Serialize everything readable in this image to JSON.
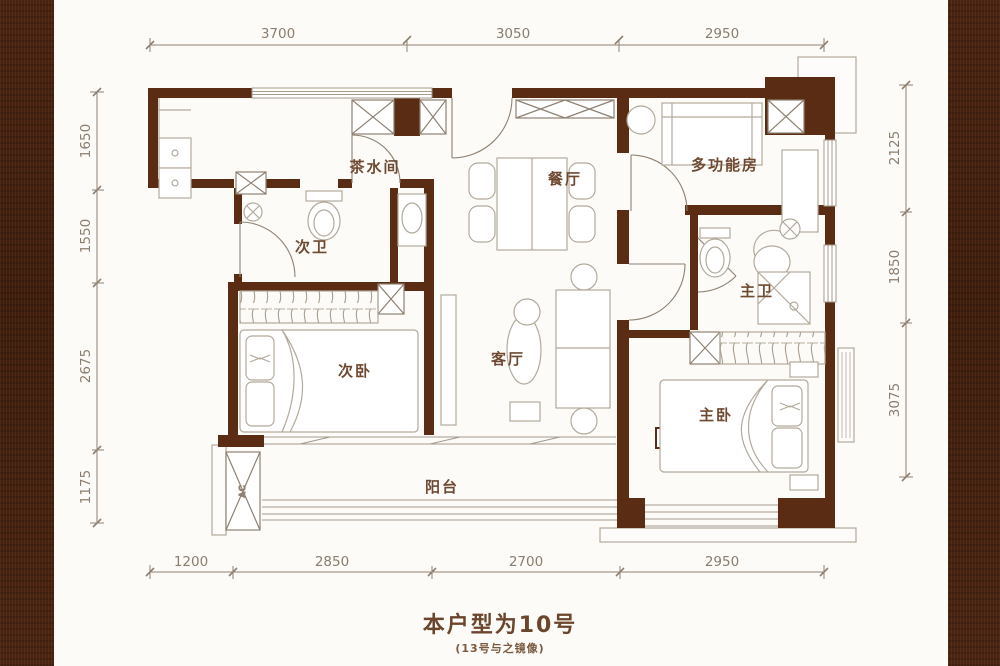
{
  "page": {
    "caption_title": "本户型为10号",
    "caption_subtitle": "(13号与之镜像)"
  },
  "floorplan": {
    "type": "apartment-floor-plan",
    "rooms": [
      {
        "id": "tea-room",
        "label": "茶水间"
      },
      {
        "id": "dining-room",
        "label": "餐厅"
      },
      {
        "id": "multi-function",
        "label": "多功能房"
      },
      {
        "id": "second-bathroom",
        "label": "次卫"
      },
      {
        "id": "master-bathroom",
        "label": "主卫"
      },
      {
        "id": "second-bedroom",
        "label": "次卧"
      },
      {
        "id": "living-room",
        "label": "客厅"
      },
      {
        "id": "master-bedroom",
        "label": "主卧"
      },
      {
        "id": "balcony",
        "label": "阳台"
      }
    ],
    "equipment": {
      "ac_label": "AC"
    },
    "dimensions": {
      "top": [
        "3700",
        "3050",
        "2950"
      ],
      "bottom": [
        "1200",
        "2850",
        "2700",
        "2950"
      ],
      "left": [
        "1650",
        "1550",
        "2675",
        "1175"
      ],
      "right": [
        "2125",
        "1850",
        "3075"
      ]
    },
    "colors": {
      "wall": "#5b2c14",
      "side_panel": "#45200e",
      "thin_line": "#8f8172",
      "furniture_line": "#b3a99b",
      "dim_text": "#8b7d6e",
      "room_text": "#6f4a33"
    }
  }
}
